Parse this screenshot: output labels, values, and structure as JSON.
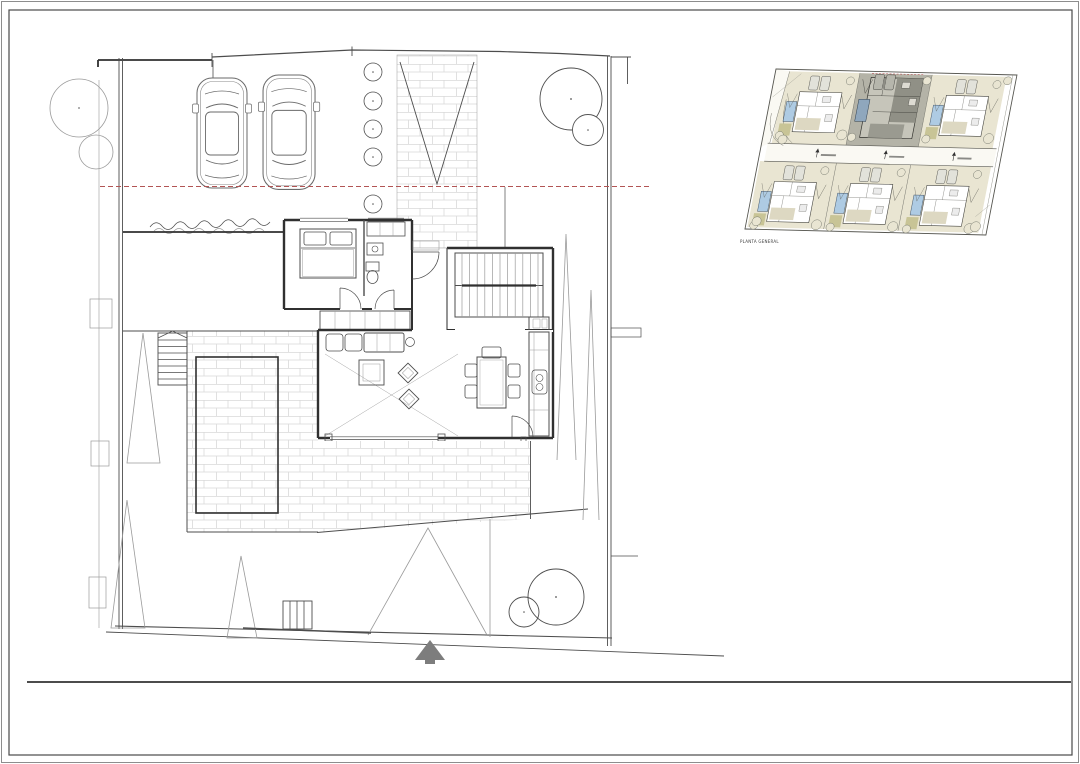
{
  "colors": {
    "page-bg": "#ffffff",
    "frame": "#4a4a4a",
    "wall": "#303030",
    "line": "#4d4d4d",
    "line-light": "#9a9a9a",
    "brick": "#d9d9d9",
    "setback-red": "#b25454",
    "north-arrow": "#7d7d7d",
    "site-ground": "#e9e5d2",
    "site-grass": "#c8c496",
    "site-gray-ground": "#b4b3a7",
    "site-gray-building": "#909086",
    "site-building-mid": "#c6c5ba",
    "site-pool": "#aecbe3",
    "site-pool-dark": "#8fa7bd",
    "site-road": "#faf9f3"
  },
  "site_plan": {
    "label": "PLANTA GENERAL",
    "lots_top_row": 3,
    "lots_bottom_row": 3,
    "highlighted_lot": "top-center"
  },
  "main_plan": {
    "cars_in_driveway": 2,
    "planter_pots": 5,
    "rooms": [
      "bedroom",
      "bathroom",
      "hall",
      "staircase",
      "living-room",
      "dining-room",
      "kitchen"
    ],
    "outdoor": [
      "driveway",
      "brick-walkway",
      "pool",
      "terrace",
      "garden",
      "hedge",
      "trees"
    ]
  },
  "north_arrow": {
    "direction": "up"
  }
}
